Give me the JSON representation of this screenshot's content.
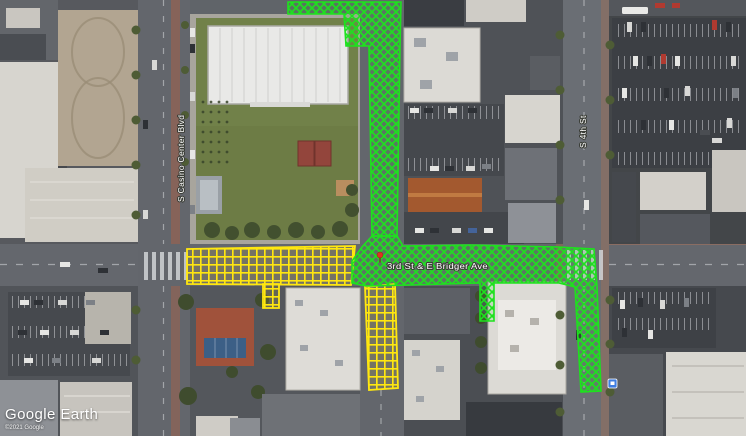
{
  "watermark": {
    "logo": "Google Earth",
    "copyright": "©2021 Google"
  },
  "street_labels": {
    "casino_center": "S Casino Center Blvd",
    "fourth_st": "S 4th St"
  },
  "placemark": {
    "label": "3rd St & E Bridger Ave"
  },
  "overlays": {
    "green_route": {
      "id": "green-closure-route",
      "pattern": "diagonal-crosshatch",
      "color": "#1ee11e"
    },
    "yellow_route": {
      "id": "yellow-closure-route",
      "pattern": "square-grid",
      "color": "#ffe70f"
    }
  },
  "markers": {
    "placemark_pin": {
      "color": "#dd3324"
    },
    "transit_stop": {
      "color": "#3f7de0"
    }
  }
}
